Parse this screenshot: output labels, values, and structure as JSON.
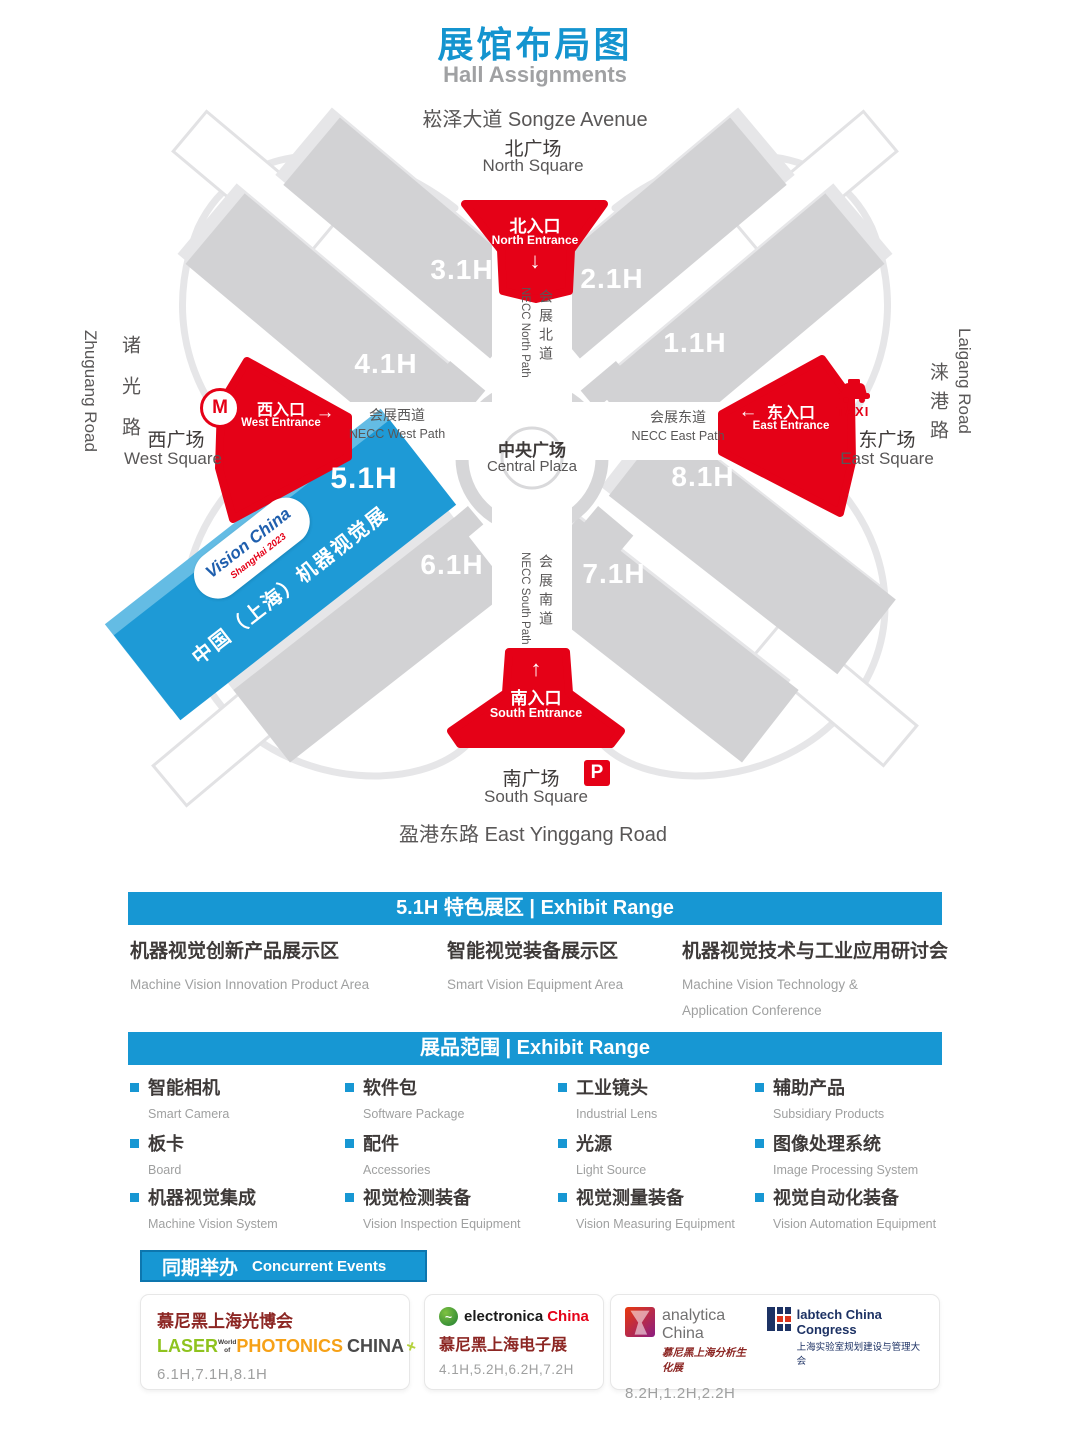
{
  "colors": {
    "accent_blue": "#1797d3",
    "accent_red": "#e50117"
  },
  "page": {
    "title_zh": "展馆布局图",
    "title_en": "Hall Assignments"
  },
  "map": {
    "road_top": "崧泽大道 Songze Avenue",
    "road_bottom": "盈港东路 East Yinggang Road",
    "road_left_zh": "诸光路",
    "road_left_en": "Zhuguang Road",
    "road_right_zh": "涞港路",
    "road_right_en": "Laigang Road",
    "square_north_zh": "北广场",
    "square_north_en": "North Square",
    "square_west_zh": "西广场",
    "square_west_en": "West Square",
    "square_east_zh": "东广场",
    "square_east_en": "East Square",
    "square_south_zh": "南广场",
    "square_south_en": "South Square",
    "entrance_north_zh": "北入口",
    "entrance_north_en": "North Entrance",
    "entrance_west_zh": "西入口",
    "entrance_west_en": "West Entrance",
    "entrance_east_zh": "东入口",
    "entrance_east_en": "East Entrance",
    "entrance_south_zh": "南入口",
    "entrance_south_en": "South Entrance",
    "path_north_zh": "会展北道",
    "path_north_en": "NECC North Path",
    "path_west_zh": "会展西道",
    "path_west_en": "NECC West Path",
    "path_east_zh": "会展东道",
    "path_east_en": "NECC East Path",
    "path_south_zh": "会展南道",
    "path_south_en": "NECC South Path",
    "plaza_zh": "中央广场",
    "plaza_en": "Central Plaza",
    "halls": {
      "h11": "1.1H",
      "h21": "2.1H",
      "h31": "3.1H",
      "h41": "4.1H",
      "h51": "5.1H",
      "h61": "6.1H",
      "h71": "7.1H",
      "h81": "8.1H"
    },
    "featured": {
      "logo_top": "Vision China",
      "logo_sub": "ShangHai 2023",
      "banner": "中国（上海）机器视觉展"
    },
    "icons": {
      "metro": "M",
      "taxi": "TAXI",
      "parking": "P"
    },
    "arrows": {
      "down": "↓",
      "up": "↑",
      "left": "←",
      "right": "→"
    }
  },
  "featured_zone": {
    "header": "5.1H 特色展区 | Exhibit Range",
    "items": [
      {
        "zh": "机器视觉创新产品展示区",
        "en": "Machine Vision Innovation Product Area"
      },
      {
        "zh": "智能视觉装备展示区",
        "en": "Smart Vision Equipment Area"
      },
      {
        "zh": "机器视觉技术与工业应用研讨会",
        "en": "Machine Vision Technology & Application Conference"
      }
    ]
  },
  "exhibit_range": {
    "header": "展品范围 | Exhibit Range",
    "items": [
      {
        "zh": "智能相机",
        "en": "Smart Camera"
      },
      {
        "zh": "软件包",
        "en": "Software Package"
      },
      {
        "zh": "工业镜头",
        "en": "Industrial Lens"
      },
      {
        "zh": "辅助产品",
        "en": "Subsidiary Products"
      },
      {
        "zh": "板卡",
        "en": "Board"
      },
      {
        "zh": "配件",
        "en": "Accessories"
      },
      {
        "zh": "光源",
        "en": "Light Source"
      },
      {
        "zh": "图像处理系统",
        "en": "Image Processing System"
      },
      {
        "zh": "机器视觉集成",
        "en": "Machine Vision System"
      },
      {
        "zh": "视觉检测装备",
        "en": "Vision Inspection Equipment"
      },
      {
        "zh": "视觉测量装备",
        "en": "Vision Measuring Equipment"
      },
      {
        "zh": "视觉自动化装备",
        "en": "Vision Automation Equipment"
      }
    ]
  },
  "concurrent": {
    "header_zh": "同期举办",
    "header_en": "Concurrent Events",
    "events": [
      {
        "title_zh": "慕尼黑上海光博会",
        "laser": "LASER",
        "world_of": "World of",
        "photonics": "PHOTONICS",
        "china": "CHINA",
        "plus": "+",
        "halls": "6.1H,7.1H,8.1H"
      },
      {
        "icon_glyph": "~",
        "brand": "electronica",
        "brand_suffix": "China",
        "title_zh": "慕尼黑上海电子展",
        "halls": "4.1H,5.2H,6.2H,7.2H"
      },
      {
        "logo1_en": "analytica China",
        "logo1_zh": "慕尼黑上海分析生化展",
        "logo2_en": "labtech China Congress",
        "logo2_zh": "上海实验室规划建设与管理大会",
        "halls": "8.2H,1.2H,2.2H"
      }
    ]
  }
}
